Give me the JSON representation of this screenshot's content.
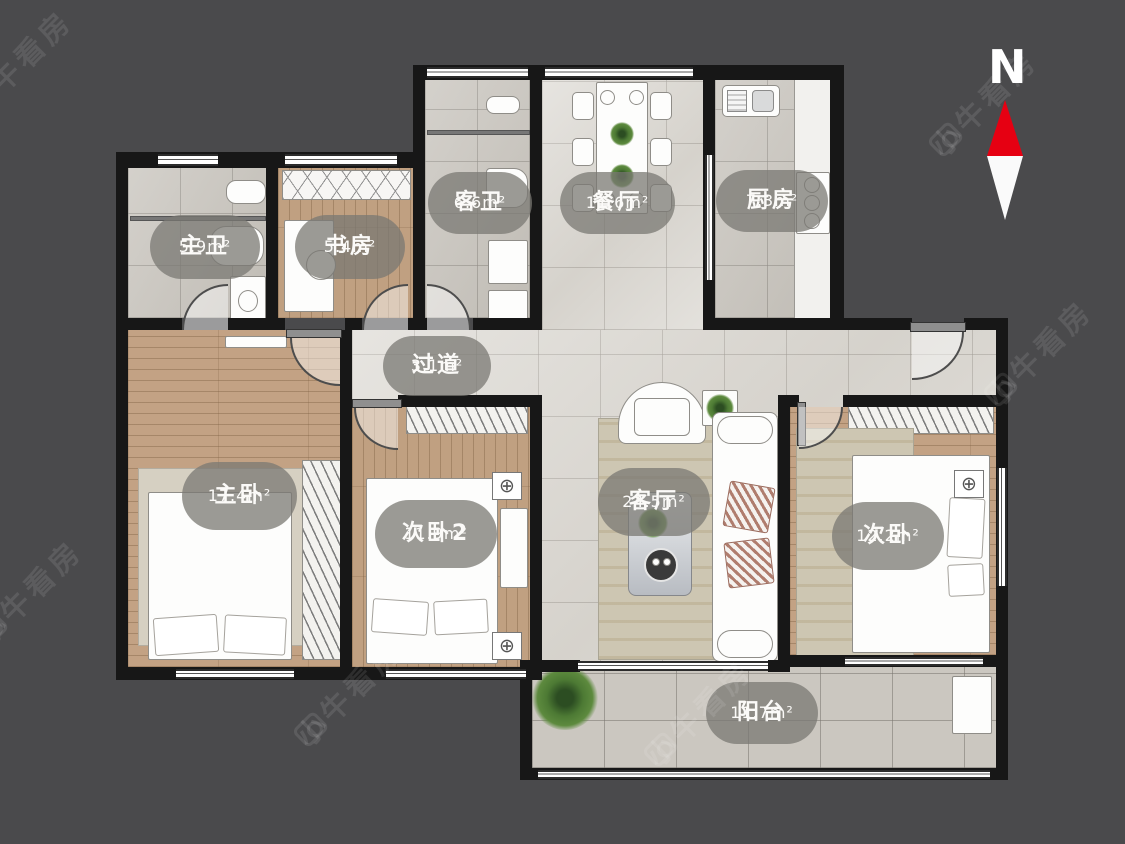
{
  "compass": {
    "label": "N"
  },
  "watermark": {
    "text": "小牛看房"
  },
  "icons": {
    "ac_symbol": "⊕"
  },
  "colors": {
    "background": "#4a4a4c",
    "wall": "#171717",
    "marble_floor": "#dcd9d3",
    "tile_floor": "#c8c4bd",
    "wood_floor": "#c3a284",
    "label_bg": "rgba(122,120,115,0.75)",
    "compass_red": "#e60012",
    "watermark_color": "rgba(255,255,255,0.10)"
  },
  "rooms": [
    {
      "id": "master-bath",
      "name": "主卫",
      "area": "5.9m²"
    },
    {
      "id": "study",
      "name": "书房",
      "area": "5.4m²"
    },
    {
      "id": "guest-bath",
      "name": "客卫",
      "area": "6.6m²"
    },
    {
      "id": "dining-room",
      "name": "餐厅",
      "area": "11.6m²"
    },
    {
      "id": "kitchen",
      "name": "厨房",
      "area": "7.3m²"
    },
    {
      "id": "hallway",
      "name": "过道",
      "area": "3.1m²"
    },
    {
      "id": "master-bedroom",
      "name": "主卧",
      "area": "17.4m²"
    },
    {
      "id": "bedroom-2",
      "name": "次卧2",
      "area": "11.9m²"
    },
    {
      "id": "living-room",
      "name": "客厅",
      "area": "24.5m²"
    },
    {
      "id": "bedroom-3",
      "name": "次卧",
      "area": "12.2m²"
    },
    {
      "id": "balcony",
      "name": "阳台",
      "area": "11.7m²"
    }
  ]
}
